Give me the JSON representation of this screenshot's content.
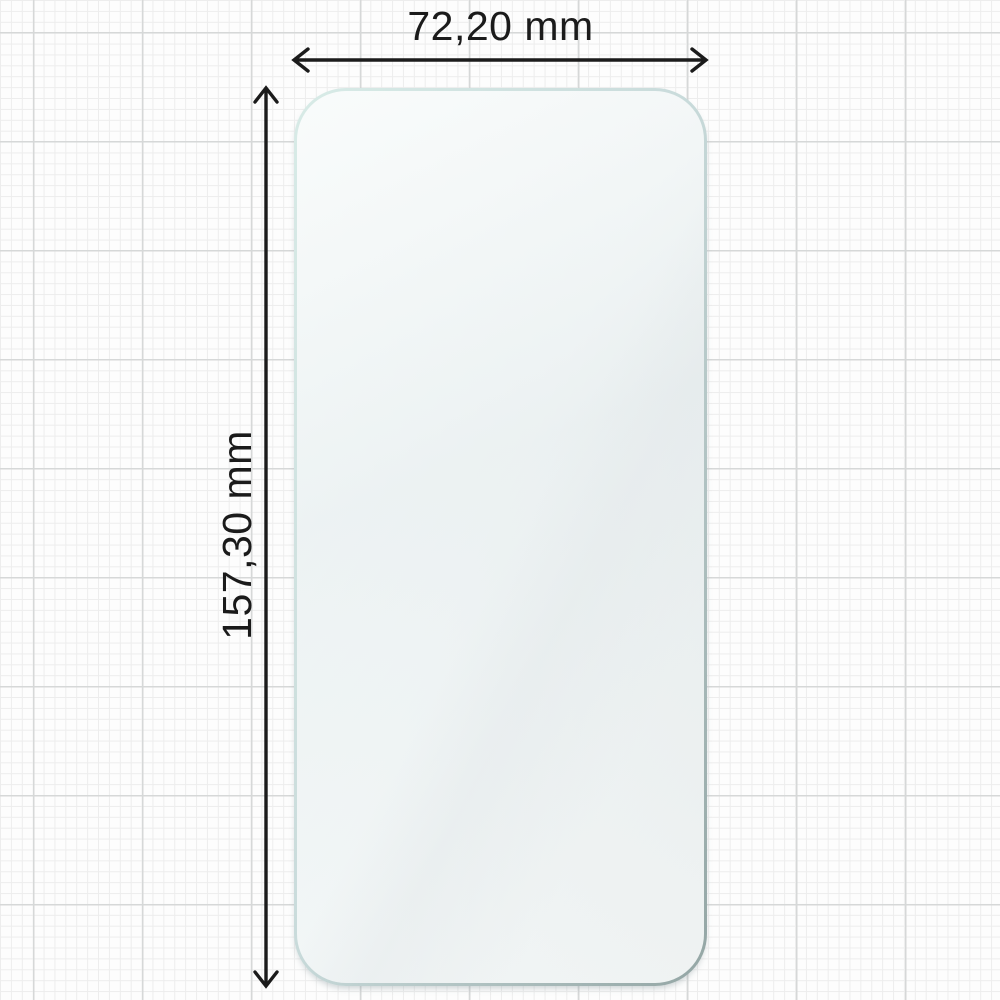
{
  "diagram": {
    "type": "product-dimension-diagram",
    "subject": "phone-screen-protector-glass",
    "width_label": "72,20 mm",
    "height_label": "157,30 mm",
    "width_value_mm": 72.2,
    "height_value_mm": 157.3,
    "unit": "mm"
  },
  "colors": {
    "text": "#1b1b1b",
    "arrow": "#1b1b1b",
    "paper": "#fdfdfd",
    "grid_minor": "#ededed",
    "grid_major": "#d6d8d8",
    "glass_edge_light": "#d8ebe7",
    "glass_edge_mid": "#c9dbdb",
    "glass_edge_dark": "#93a5a4"
  }
}
